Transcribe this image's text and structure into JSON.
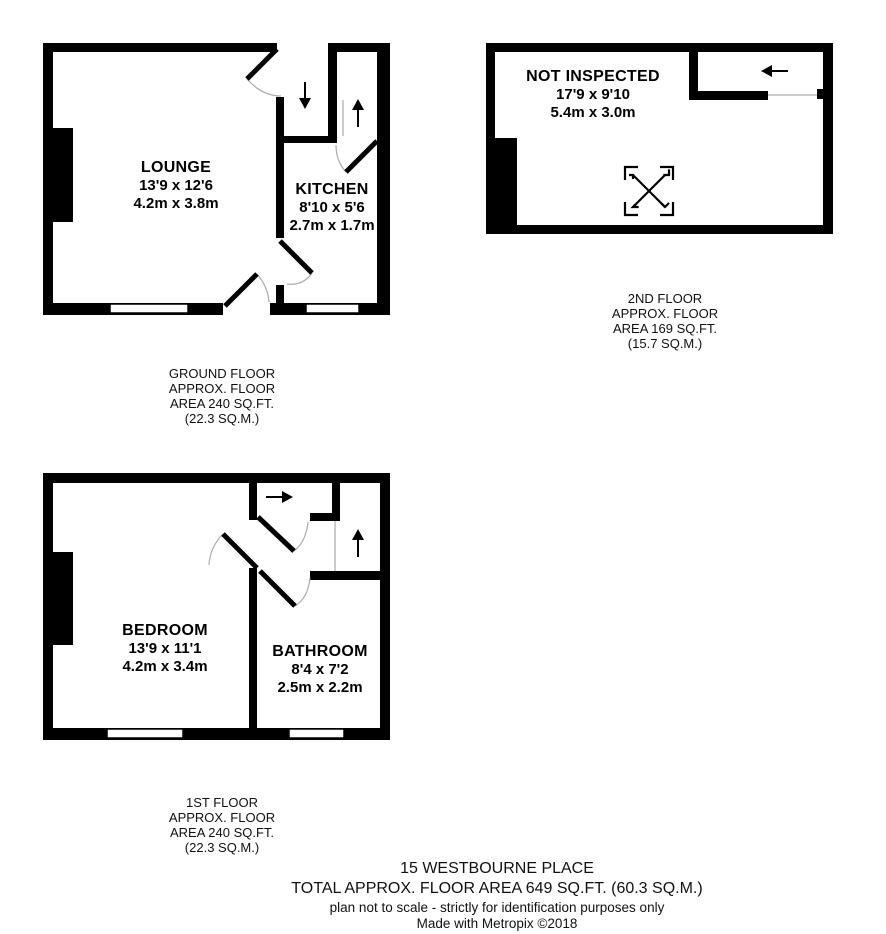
{
  "colors": {
    "wall": "#000000",
    "background": "#ffffff",
    "door_arc": "#aaaaaa",
    "stair_edge": "#999999"
  },
  "floors": {
    "ground": {
      "rooms": {
        "lounge": {
          "name": "LOUNGE",
          "imperial": "13'9 x 12'6",
          "metric": "4.2m x 3.8m"
        },
        "kitchen": {
          "name": "KITCHEN",
          "imperial": "8'10 x 5'6",
          "metric": "2.7m x 1.7m"
        }
      },
      "label": [
        "GROUND FLOOR",
        "APPROX. FLOOR",
        "AREA 240 SQ.FT.",
        "(22.3 SQ.M.)"
      ]
    },
    "second": {
      "rooms": {
        "not_inspected": {
          "name": "NOT INSPECTED",
          "imperial": "17'9 x 9'10",
          "metric": "5.4m x 3.0m"
        }
      },
      "label": [
        "2ND FLOOR",
        "APPROX. FLOOR",
        "AREA 169 SQ.FT.",
        "(15.7 SQ.M.)"
      ]
    },
    "first": {
      "rooms": {
        "bedroom": {
          "name": "BEDROOM",
          "imperial": "13'9 x 11'1",
          "metric": "4.2m x 3.4m"
        },
        "bathroom": {
          "name": "BATHROOM",
          "imperial": "8'4 x 7'2",
          "metric": "2.5m x 2.2m"
        }
      },
      "label": [
        "1ST FLOOR",
        "APPROX. FLOOR",
        "AREA 240 SQ.FT.",
        "(22.3 SQ.M.)"
      ]
    }
  },
  "icons": {
    "ground_floor": [
      "stairs-down-arrow",
      "stairs-up-arrow"
    ],
    "second_floor": [
      "stairs-left-arrow",
      "not-inspected-cross"
    ],
    "first_floor": [
      "stairs-right-arrow",
      "stairs-up-arrow"
    ]
  },
  "footer": {
    "address": "15 WESTBOURNE PLACE",
    "total": "TOTAL APPROX. FLOOR AREA 649 SQ.FT. (60.3 SQ.M.)",
    "disclaimer": "plan not to scale - strictly for identification purposes only",
    "credit": "Made with Metropix ©2018"
  }
}
